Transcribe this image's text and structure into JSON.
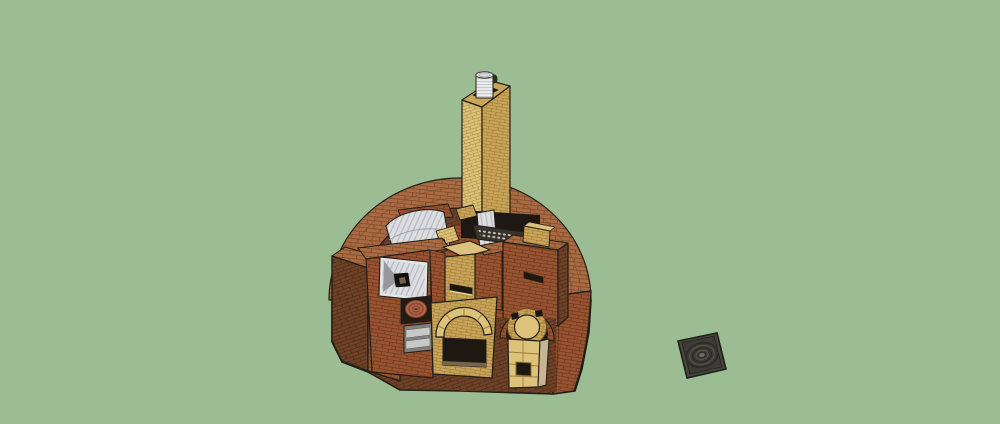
{
  "viewport": {
    "kind": "3d-modeling-canvas",
    "description": "SketchUp-style orbit view of a sectioned brick masonry heater on a plain green ground",
    "visible_text": []
  },
  "scene": {
    "colors": {
      "bg": "#9cbc93",
      "outline": "#221f18",
      "brick_top": "#a96b43",
      "brick_front": "#9a5330",
      "brick_shadow": "#6f4228",
      "brick_joint": "#7e4a2a",
      "brick_joint_dark": "#6d3a20",
      "brick_joint_shadow": "#4f2d18",
      "fire_light": "#ddc27b",
      "fire_mid": "#c9a55b",
      "fire_joint": "#a07f35",
      "metal_light": "#dcdde0",
      "metal_stripe": "#b4b5bb",
      "metal_facet": "#97989d",
      "opening": "#1d1812",
      "terracotta": "#b2664a",
      "terracotta_dark": "#8b4a30",
      "grate_dark": "#38332a",
      "grate_dot": "#c9cac4",
      "pipe_white": "#ededee",
      "pipe_ridge": "#c2c3c7",
      "door_gray": "#c8c8c6",
      "door_frame": "#7f7f7d",
      "sill_brown": "#77644e",
      "iron_body": "#474641",
      "iron_ring": "#2b2a27",
      "iron_hub": "#6a6a64"
    },
    "objects": [
      {
        "id": "masonry-heater",
        "label": "Sectioned semicircular brick masonry heater"
      },
      {
        "id": "chimney",
        "label": "Firebrick chimney column"
      },
      {
        "id": "flue-pipe",
        "label": "Corrugated metal flue liner at chimney top"
      },
      {
        "id": "corrugated-vault",
        "label": "Corrugated metal vault over left chamber"
      },
      {
        "id": "hopper-funnel",
        "label": "Sheet-metal funnel hopper with square chute"
      },
      {
        "id": "terracotta-coil",
        "label": "Terracotta coil in wall alcove"
      },
      {
        "id": "cleanout-door",
        "label": "Gray cleanout door"
      },
      {
        "id": "heat-grate",
        "label": "Metal heat-exchange grate"
      },
      {
        "id": "firebox",
        "label": "Arched firebrick firebox with opening"
      },
      {
        "id": "bell-column",
        "label": "Round-top firebrick bell column in brick arch recess"
      },
      {
        "id": "brick-tower",
        "label": "Red brick tower with vent slot and firebrick cap"
      },
      {
        "id": "cast-iron-plate",
        "label": "Cast iron cooking plate with concentric rings"
      }
    ]
  }
}
